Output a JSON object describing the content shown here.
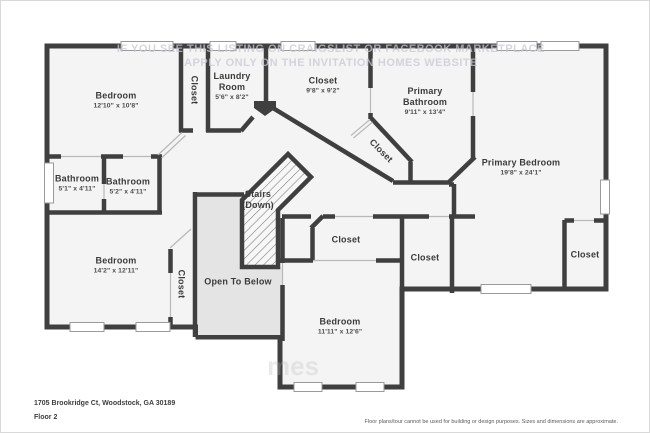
{
  "floorplan": {
    "colors": {
      "wall": "#3f3f3f",
      "room_fill": "#f4f4f4",
      "open_to_below_fill": "#e4e4e4",
      "window_stroke": "#9a9a9a",
      "door_line": "#b8b8b8"
    },
    "rooms": [
      {
        "id": "bedroom-1",
        "name": "Bedroom",
        "dims": "12'10\" x 10'8\"",
        "x": 115,
        "y": 99
      },
      {
        "id": "closet-hall",
        "name": "Closet",
        "x": 193,
        "y": 89,
        "rot": 90
      },
      {
        "id": "laundry-room",
        "name": "Laundry Room",
        "dims": "5'6\" x 8'2\"",
        "x": 231,
        "y": 85,
        "w": 52
      },
      {
        "id": "closet-primary-walkin",
        "name": "Closet",
        "dims": "9'8\" x 9'2\"",
        "x": 322,
        "y": 84
      },
      {
        "id": "primary-bathroom",
        "name": "Primary Bathroom",
        "dims": "9'11\" x 13'4\"",
        "x": 424,
        "y": 100,
        "w": 62
      },
      {
        "id": "closet-diagonal",
        "name": "Closet",
        "x": 380,
        "y": 150,
        "rot": 45
      },
      {
        "id": "primary-bedroom",
        "name": "Primary Bedroom",
        "dims": "19'8\" x 24'1\"",
        "x": 520,
        "y": 166
      },
      {
        "id": "stairs",
        "name": "Stairs",
        "sub": "(Down)",
        "x": 257,
        "y": 199
      },
      {
        "id": "bathroom-1",
        "name": "Bathroom",
        "dims": "5'1\" x 4'11\"",
        "x": 76,
        "y": 182
      },
      {
        "id": "bathroom-2",
        "name": "Bathroom",
        "dims": "5'2\" x 4'11\"",
        "x": 127,
        "y": 185
      },
      {
        "id": "bedroom-2",
        "name": "Bedroom",
        "dims": "14'2\" x 12'11\"",
        "x": 115,
        "y": 264
      },
      {
        "id": "closet-bedroom-2",
        "name": "Closet",
        "x": 180,
        "y": 283,
        "rot": 90
      },
      {
        "id": "open-to-below",
        "name": "Open To Below",
        "x": 237,
        "y": 281
      },
      {
        "id": "closet-bedroom-3",
        "name": "Closet",
        "x": 345,
        "y": 239
      },
      {
        "id": "closet-hall-2",
        "name": "Closet",
        "x": 424,
        "y": 257
      },
      {
        "id": "bedroom-3",
        "name": "Bedroom",
        "dims": "11'11\" x 12'6\"",
        "x": 339,
        "y": 325
      },
      {
        "id": "closet-primary-2",
        "name": "Closet",
        "x": 584,
        "y": 254
      }
    ],
    "watermark": {
      "line1": "IF YOU SEE THIS LISTING ON CRAIGSLIST OR FACEBOOK MARKETPLACE",
      "line2": "APPLY ONLY ON THE INVITATION HOMES WEBSITE",
      "partial": "mes"
    },
    "footer": {
      "address": "1705 Brookridge Ct, Woodstock, GA 30189",
      "floor_label": "Floor 2",
      "disclaimer": "Floor plans/tour cannot be used for building or design purposes. Sizes and dimensions are approximate."
    }
  }
}
